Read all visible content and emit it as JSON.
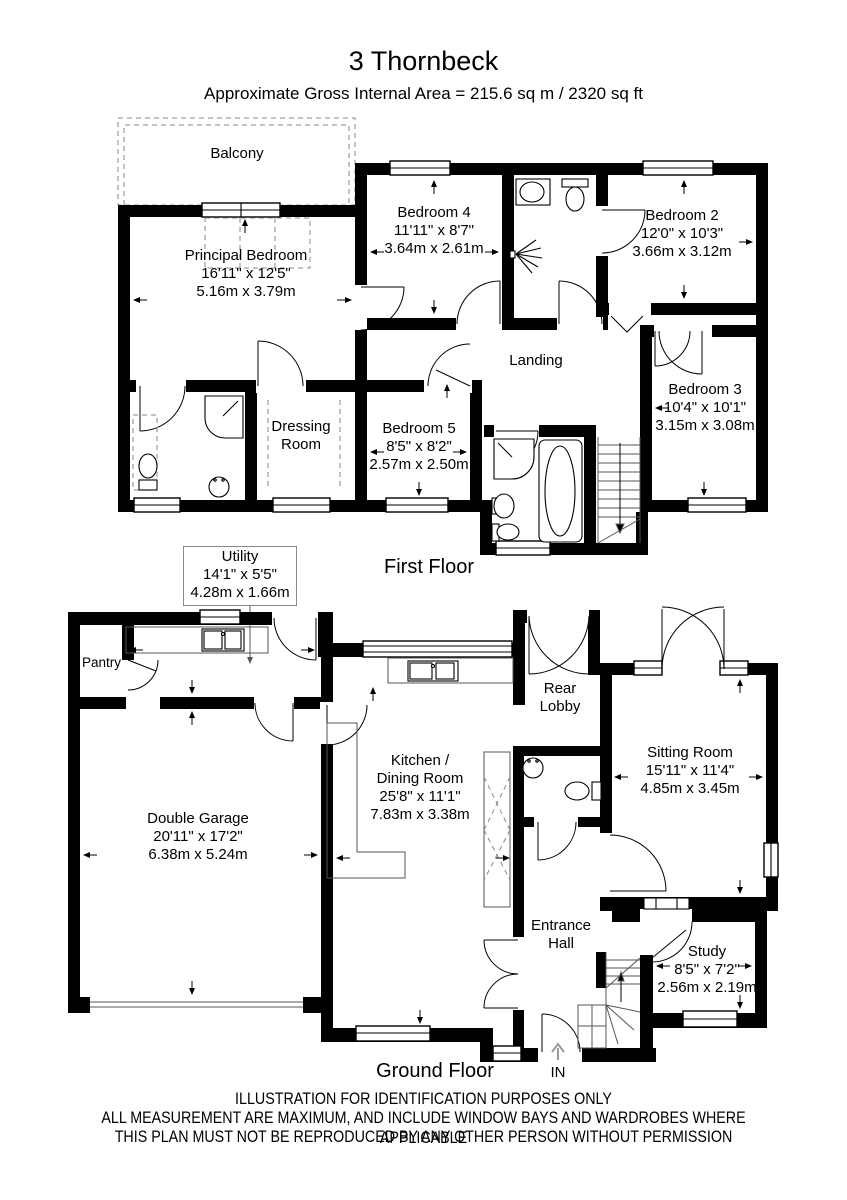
{
  "header": {
    "title": "3 Thornbeck",
    "subtitle": "Approximate Gross Internal Area = 215.6 sq m / 2320 sq ft"
  },
  "first_floor": {
    "floor_label": "First Floor",
    "balcony": {
      "name": "Balcony"
    },
    "principal_bedroom": {
      "name": "Principal Bedroom",
      "imperial": "16'11\" x 12'5\"",
      "metric": "5.16m x 3.79m"
    },
    "bedroom4": {
      "name": "Bedroom 4",
      "imperial": "11'11\" x 8'7\"",
      "metric": "3.64m x 2.61m"
    },
    "bedroom2": {
      "name": "Bedroom 2",
      "imperial": "12'0\" x 10'3\"",
      "metric": "3.66m x 3.12m"
    },
    "bedroom3": {
      "name": "Bedroom 3",
      "imperial": "10'4\" x 10'1\"",
      "metric": "3.15m x 3.08m"
    },
    "bedroom5": {
      "name": "Bedroom 5",
      "imperial": "8'5\" x 8'2\"",
      "metric": "2.57m x 2.50m"
    },
    "dressing_room": {
      "line1": "Dressing",
      "line2": "Room"
    },
    "landing": {
      "name": "Landing"
    }
  },
  "utility_callout": {
    "name": "Utility",
    "imperial": "14'1\" x 5'5\"",
    "metric": "4.28m x 1.66m"
  },
  "ground_floor": {
    "floor_label": "Ground Floor",
    "pantry": {
      "name": "Pantry"
    },
    "double_garage": {
      "name": "Double Garage",
      "imperial": "20'11\" x 17'2\"",
      "metric": "6.38m x 5.24m"
    },
    "kitchen_dining": {
      "line1": "Kitchen /",
      "line2": "Dining Room",
      "imperial": "25'8\" x 11'1\"",
      "metric": "7.83m x 3.38m"
    },
    "rear_lobby": {
      "line1": "Rear",
      "line2": "Lobby"
    },
    "sitting_room": {
      "name": "Sitting Room",
      "imperial": "15'11\" x 11'4\"",
      "metric": "4.85m x 3.45m"
    },
    "entrance_hall": {
      "line1": "Entrance",
      "line2": "Hall"
    },
    "study": {
      "name": "Study",
      "imperial": "8'5\" x 7'2\"",
      "metric": "2.56m x 2.19m"
    },
    "entrance": {
      "in_label": "IN"
    }
  },
  "footer": {
    "line1": "ILLUSTRATION FOR IDENTIFICATION PURPOSES ONLY",
    "line2": "ALL MEASUREMENT  ARE MAXIMUM, AND INCLUDE WINDOW BAYS AND WARDROBES WHERE APPLICABLE",
    "line3": "THIS PLAN MUST NOT BE REPRODUCED BY ANY OTHER PERSON WITHOUT PERMISSION"
  }
}
